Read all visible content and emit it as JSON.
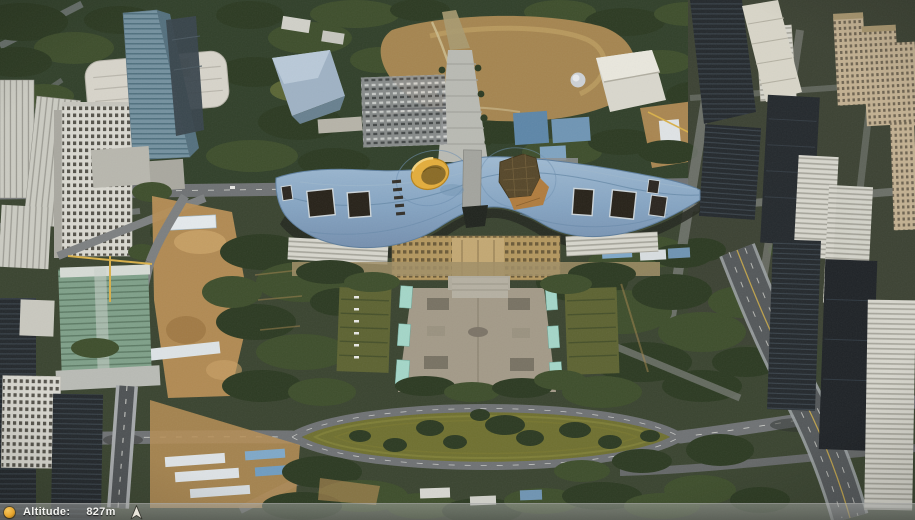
{
  "app": {
    "view": "3d-aerial-map",
    "scene": "dense city blocks around a long wavy-roof civic building, central plaza, lens-shaped lawn ring and elevated highways"
  },
  "status_bar": {
    "altitude_label": "Altitude:",
    "altitude_value": "827m",
    "status_icon": "orange-globe-icon",
    "compass_icon": "north-arrow-icon"
  },
  "colors": {
    "tree_dark": "#2c3a22",
    "grass_olive": "#6f7030",
    "dirt_tan": "#b78e55",
    "road_gray": "#6f7274",
    "plaza_tan": "#a39a88",
    "water_pool": "#a4d6c8",
    "roof_blue": "#85a4c2",
    "turret_yellow": "#e3ad3c",
    "dome_brown": "#56472a",
    "lane_yellow": "#c8a94a",
    "status_text": "#f4f4f1",
    "status_icon_orange": "#e8a62e"
  }
}
